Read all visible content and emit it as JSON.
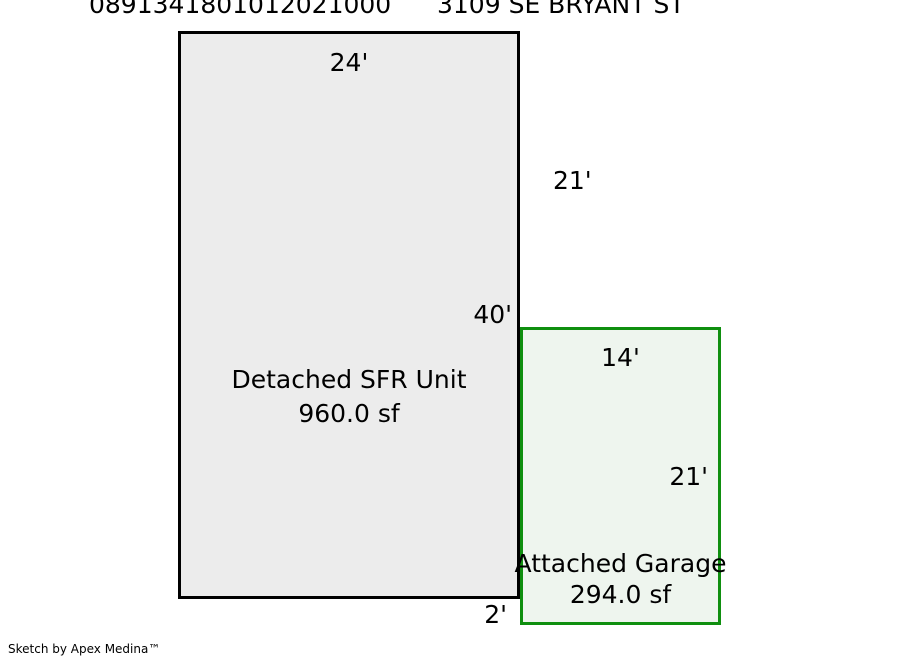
{
  "header": {
    "parcel_id": "0891341801012021000",
    "address": "3109 SE BRYANT ST"
  },
  "sketch": {
    "main_unit": {
      "label": "Detached SFR Unit",
      "area": "960.0 sf",
      "fill_color": "#ececec",
      "border_color": "#000000",
      "dims": {
        "top": "24'",
        "right_upper": "21'",
        "right_lower": "40'",
        "bottom_offset": "2'"
      }
    },
    "garage": {
      "label": "Attached Garage",
      "area": "294.0 sf",
      "fill_color": "#eef5ee",
      "border_color": "#0f8f0f",
      "dims": {
        "top": "14'",
        "right": "21'"
      }
    }
  },
  "footer": {
    "credit": "Sketch by Apex Medina™"
  }
}
